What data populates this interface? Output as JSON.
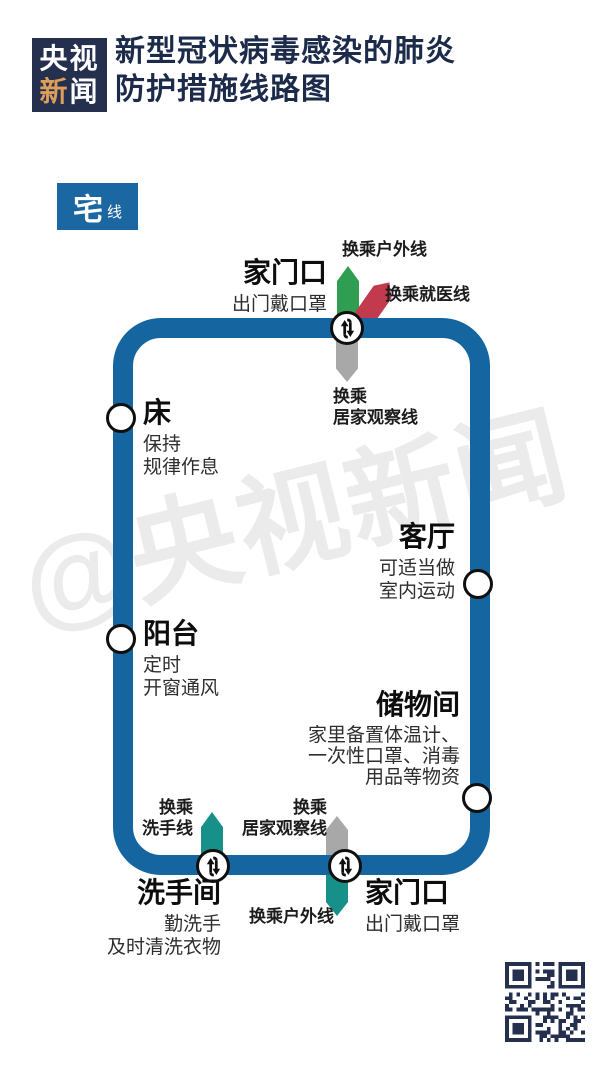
{
  "header": {
    "logo_line1": "央视",
    "logo_char_gold": "新",
    "logo_char_white": "闻",
    "title_line1": "新型冠状病毒感染的肺炎",
    "title_line2": "防护措施线路图"
  },
  "line_badge": {
    "main": "宅",
    "suffix": "线"
  },
  "watermark": "@央视新闻",
  "colors": {
    "navy": "#25304f",
    "title_navy": "#1c2b4a",
    "gold": "#dd9e5b",
    "line_blue": "#1465a0",
    "badge_blue": "#1a67a1",
    "green": "#2f9e52",
    "red": "#c23a4e",
    "teal": "#17908a",
    "gray": "#a8a8a8",
    "watermark_gray": "#ebebeb"
  },
  "stations": {
    "door_top": {
      "name": "家门口",
      "note": "出门戴口罩"
    },
    "bed": {
      "name": "床",
      "note_lines": [
        "保持",
        "规律作息"
      ]
    },
    "living_room": {
      "name": "客厅",
      "note_lines": [
        "可适当做",
        "室内运动"
      ]
    },
    "balcony": {
      "name": "阳台",
      "note_lines": [
        "定时",
        "开窗通风"
      ]
    },
    "storage": {
      "name": "储物间",
      "note_lines": [
        "家里备置体温计、",
        "一次性口罩、消毒",
        "用品等物资"
      ]
    },
    "bathroom": {
      "name": "洗手间",
      "note_lines": [
        "勤洗手",
        "及时清洗衣物"
      ]
    },
    "door_bottom": {
      "name": "家门口",
      "note": "出门戴口罩"
    }
  },
  "transfers": {
    "outdoor_top": "换乘户外线",
    "medical": "换乘就医线",
    "observation_top": [
      "换乘",
      "居家观察线"
    ],
    "handwash": [
      "换乘",
      "洗手线"
    ],
    "observation_bottom": [
      "换乘",
      "居家观察线"
    ],
    "outdoor_bottom": "换乘户外线"
  }
}
